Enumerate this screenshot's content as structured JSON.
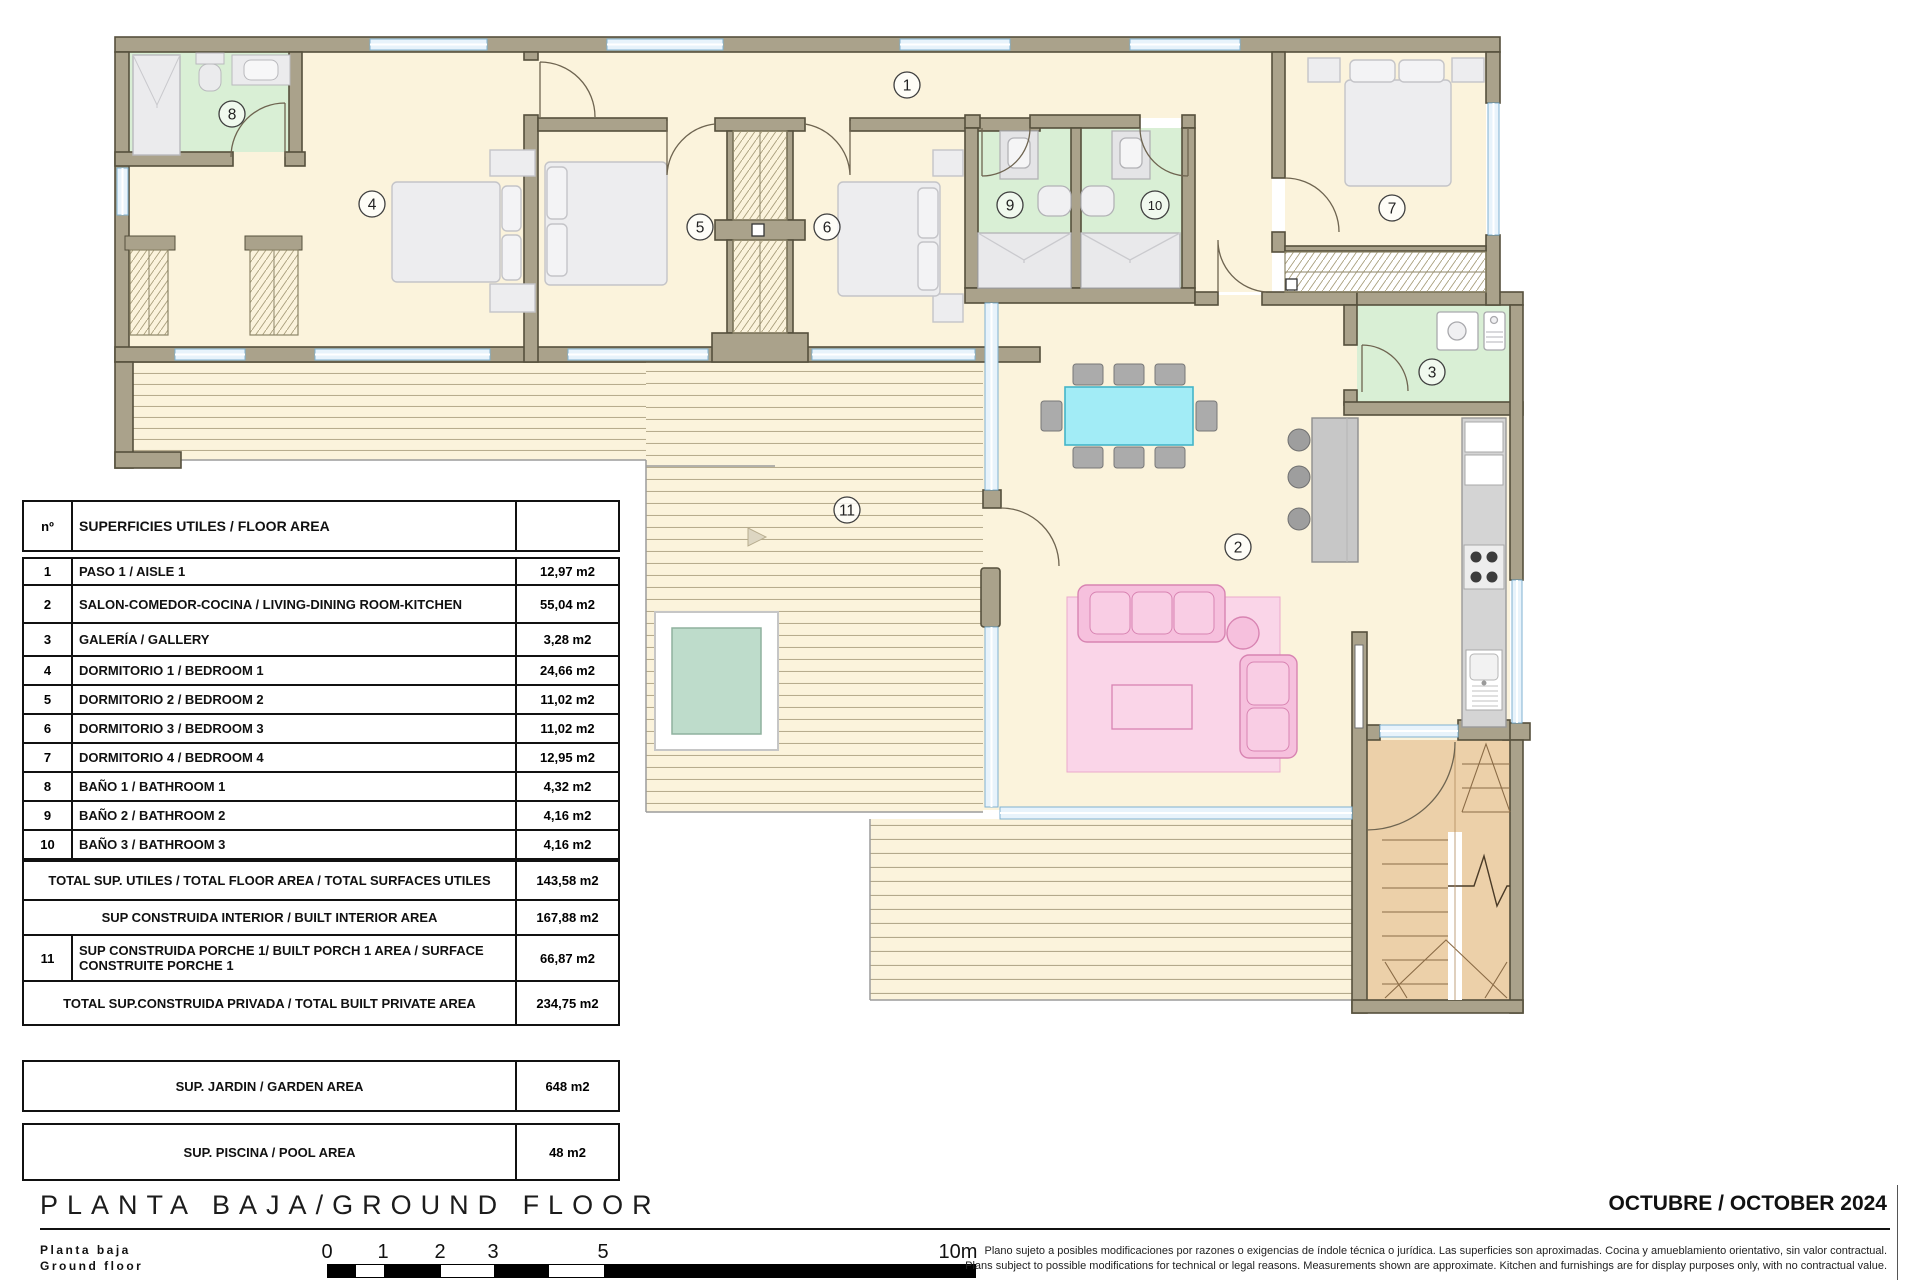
{
  "plan": {
    "room_numbers": [
      "1",
      "2",
      "3",
      "4",
      "5",
      "6",
      "7",
      "8",
      "9",
      "10",
      "11"
    ],
    "colors": {
      "floor": "#fbf3dc",
      "wall": "#aaa28b",
      "wall_outline": "#56503d",
      "bathroom_floor": "#d9efd5",
      "window": "#e8f3fb",
      "deck_line": "#b7ac8e",
      "pool_water": "#bedccb",
      "stairs": "#ecd0a9",
      "dining_table": "#a2ecf6",
      "sofa": "#f6c0dd",
      "rug": "#fad5e8",
      "bed": "#ededef",
      "counter": "#d2d2d2"
    }
  },
  "area_table": {
    "header": {
      "col_num": "nº",
      "col_label": "SUPERFICIES UTILES / FLOOR AREA",
      "col_value": ""
    },
    "rows": [
      {
        "num": "1",
        "label": "PASO 1 / AISLE 1",
        "value": "12,97 m2"
      },
      {
        "num": "2",
        "label": "SALON-COMEDOR-COCINA /  LIVING-DINING ROOM-KITCHEN",
        "value": "55,04 m2"
      },
      {
        "num": "3",
        "label": "GALERÍA / GALLERY",
        "value": "3,28 m2"
      },
      {
        "num": "4",
        "label": "DORMITORIO 1 / BEDROOM 1",
        "value": "24,66 m2"
      },
      {
        "num": "5",
        "label": "DORMITORIO 2 / BEDROOM 2",
        "value": "11,02 m2"
      },
      {
        "num": "6",
        "label": "DORMITORIO 3 / BEDROOM 3",
        "value": "11,02 m2"
      },
      {
        "num": "7",
        "label": "DORMITORIO 4 / BEDROOM 4",
        "value": "12,95 m2"
      },
      {
        "num": "8",
        "label": "BAÑO 1 / BATHROOM 1",
        "value": "4,32 m2"
      },
      {
        "num": "9",
        "label": "BAÑO 2 / BATHROOM 2",
        "value": "4,16 m2"
      },
      {
        "num": "10",
        "label": "BAÑO 3 / BATHROOM 3",
        "value": "4,16 m2"
      }
    ],
    "totals": [
      {
        "num": "",
        "label": "TOTAL SUP. UTILES / TOTAL FLOOR AREA / TOTAL SURFACES UTILES",
        "value": "143,58 m2"
      },
      {
        "num": "",
        "label": "SUP CONSTRUIDA INTERIOR / BUILT INTERIOR AREA",
        "value": "167,88 m2"
      },
      {
        "num": "11",
        "label": "SUP CONSTRUIDA PORCHE 1/ BUILT PORCH 1 AREA / SURFACE CONSTRUITE PORCHE 1",
        "value": "66,87 m2"
      },
      {
        "num": "",
        "label": "TOTAL SUP.CONSTRUIDA PRIVADA / TOTAL  BUILT PRIVATE AREA",
        "value": "234,75 m2"
      }
    ],
    "garden": {
      "label": "SUP. JARDIN / GARDEN AREA",
      "value": "648 m2"
    },
    "pool": {
      "label": "SUP. PISCINA / POOL AREA",
      "value": "48 m2"
    }
  },
  "footer": {
    "title": "PLANTA BAJA/GROUND FLOOR",
    "subtitle_line1": "Planta baja",
    "subtitle_line2": "Ground floor",
    "date": "OCTUBRE / OCTOBER 2024",
    "disclaimer_es": "Plano sujeto a posibles modificaciones por razones o exigencias de índole técnica o jurídica. Las superficies son aproximadas. Cocina y amueblamiento orientativo, sin valor contractual.",
    "disclaimer_en": "Plans subject to possible modifications for technical or legal reasons. Measurements shown are approximate. Kitchen and furnishings are for display purposes only, with no contractual value.",
    "scale_labels": [
      "0",
      "1",
      "2",
      "3",
      "5",
      "10m"
    ]
  }
}
